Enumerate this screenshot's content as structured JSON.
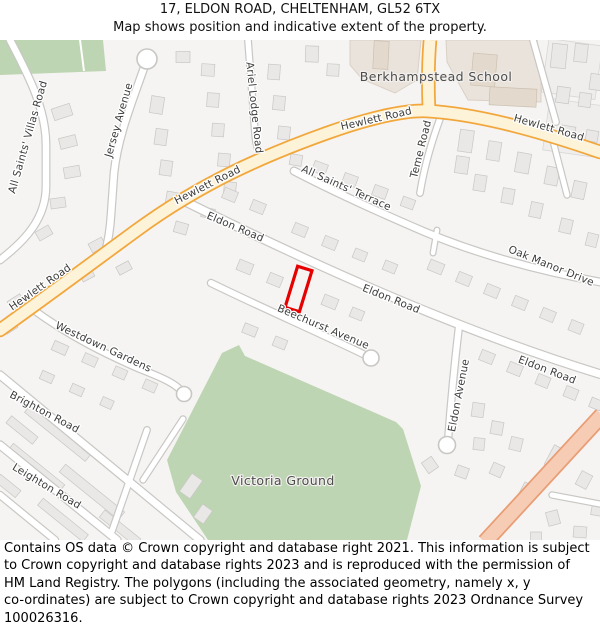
{
  "header": {
    "title": "17, ELDON ROAD, CHELTENHAM, GL52 6TX",
    "subtitle": "Map shows position and indicative extent of the property."
  },
  "map": {
    "property_ref": "17 Eldon Road property outline",
    "area_labels": [
      {
        "text": "Berkhampstead School",
        "x": 436,
        "y": 41,
        "rotate": 0
      },
      {
        "text": "Victoria Ground",
        "x": 283,
        "y": 445,
        "rotate": 0
      }
    ],
    "road_labels": [
      {
        "text": "All Saints' Villas Road",
        "x": 31,
        "y": 98,
        "rotate": -74
      },
      {
        "text": "Jersey Avenue",
        "x": 122,
        "y": 81,
        "rotate": -74
      },
      {
        "text": "Ariel Lodge Road",
        "x": 251,
        "y": 68,
        "rotate": 84
      },
      {
        "text": "Hewlett Road",
        "x": 42,
        "y": 250,
        "rotate": -35
      },
      {
        "text": "Hewlett Road",
        "x": 209,
        "y": 148,
        "rotate": -27
      },
      {
        "text": "Hewlett Road",
        "x": 377,
        "y": 82,
        "rotate": -13
      },
      {
        "text": "Hewlett Road",
        "x": 548,
        "y": 91,
        "rotate": 16
      },
      {
        "text": "All Saints' Terrace",
        "x": 345,
        "y": 151,
        "rotate": 24
      },
      {
        "text": "Teme Road",
        "x": 424,
        "y": 110,
        "rotate": -76
      },
      {
        "text": "Oak Manor Drive",
        "x": 550,
        "y": 229,
        "rotate": 22
      },
      {
        "text": "Eldon Road",
        "x": 234,
        "y": 190,
        "rotate": 23
      },
      {
        "text": "Eldon Road",
        "x": 390,
        "y": 262,
        "rotate": 22
      },
      {
        "text": "Eldon Road",
        "x": 546,
        "y": 333,
        "rotate": 21
      },
      {
        "text": "Beechurst Avenue",
        "x": 322,
        "y": 290,
        "rotate": 23
      },
      {
        "text": "Eldon Avenue",
        "x": 462,
        "y": 356,
        "rotate": -79
      },
      {
        "text": "Westdown Gardens",
        "x": 102,
        "y": 310,
        "rotate": 25
      },
      {
        "text": "Brighton Road",
        "x": 43,
        "y": 375,
        "rotate": 28
      },
      {
        "text": "Leighton Road",
        "x": 45,
        "y": 449,
        "rotate": 31
      }
    ],
    "colors": {
      "map-bg": "#f5f4f2",
      "green": "#bdd5b2",
      "school": "#eae3db",
      "primary-fill": "#fdf3d8",
      "primary-casing": "#f2a73d",
      "aroad-fill": "#f6ccb4",
      "aroad-casing": "#e99d74",
      "property": "#e60000"
    }
  },
  "footer": {
    "lines": [
      "Contains OS data © Crown copyright and database right 2021. This information is subject",
      "to Crown copyright and database rights 2023 and is reproduced with the permission of",
      "HM Land Registry. The polygons (including the associated geometry, namely x, y",
      "co-ordinates) are subject to Crown copyright and database rights 2023 Ordnance Survey",
      "100026316."
    ]
  }
}
